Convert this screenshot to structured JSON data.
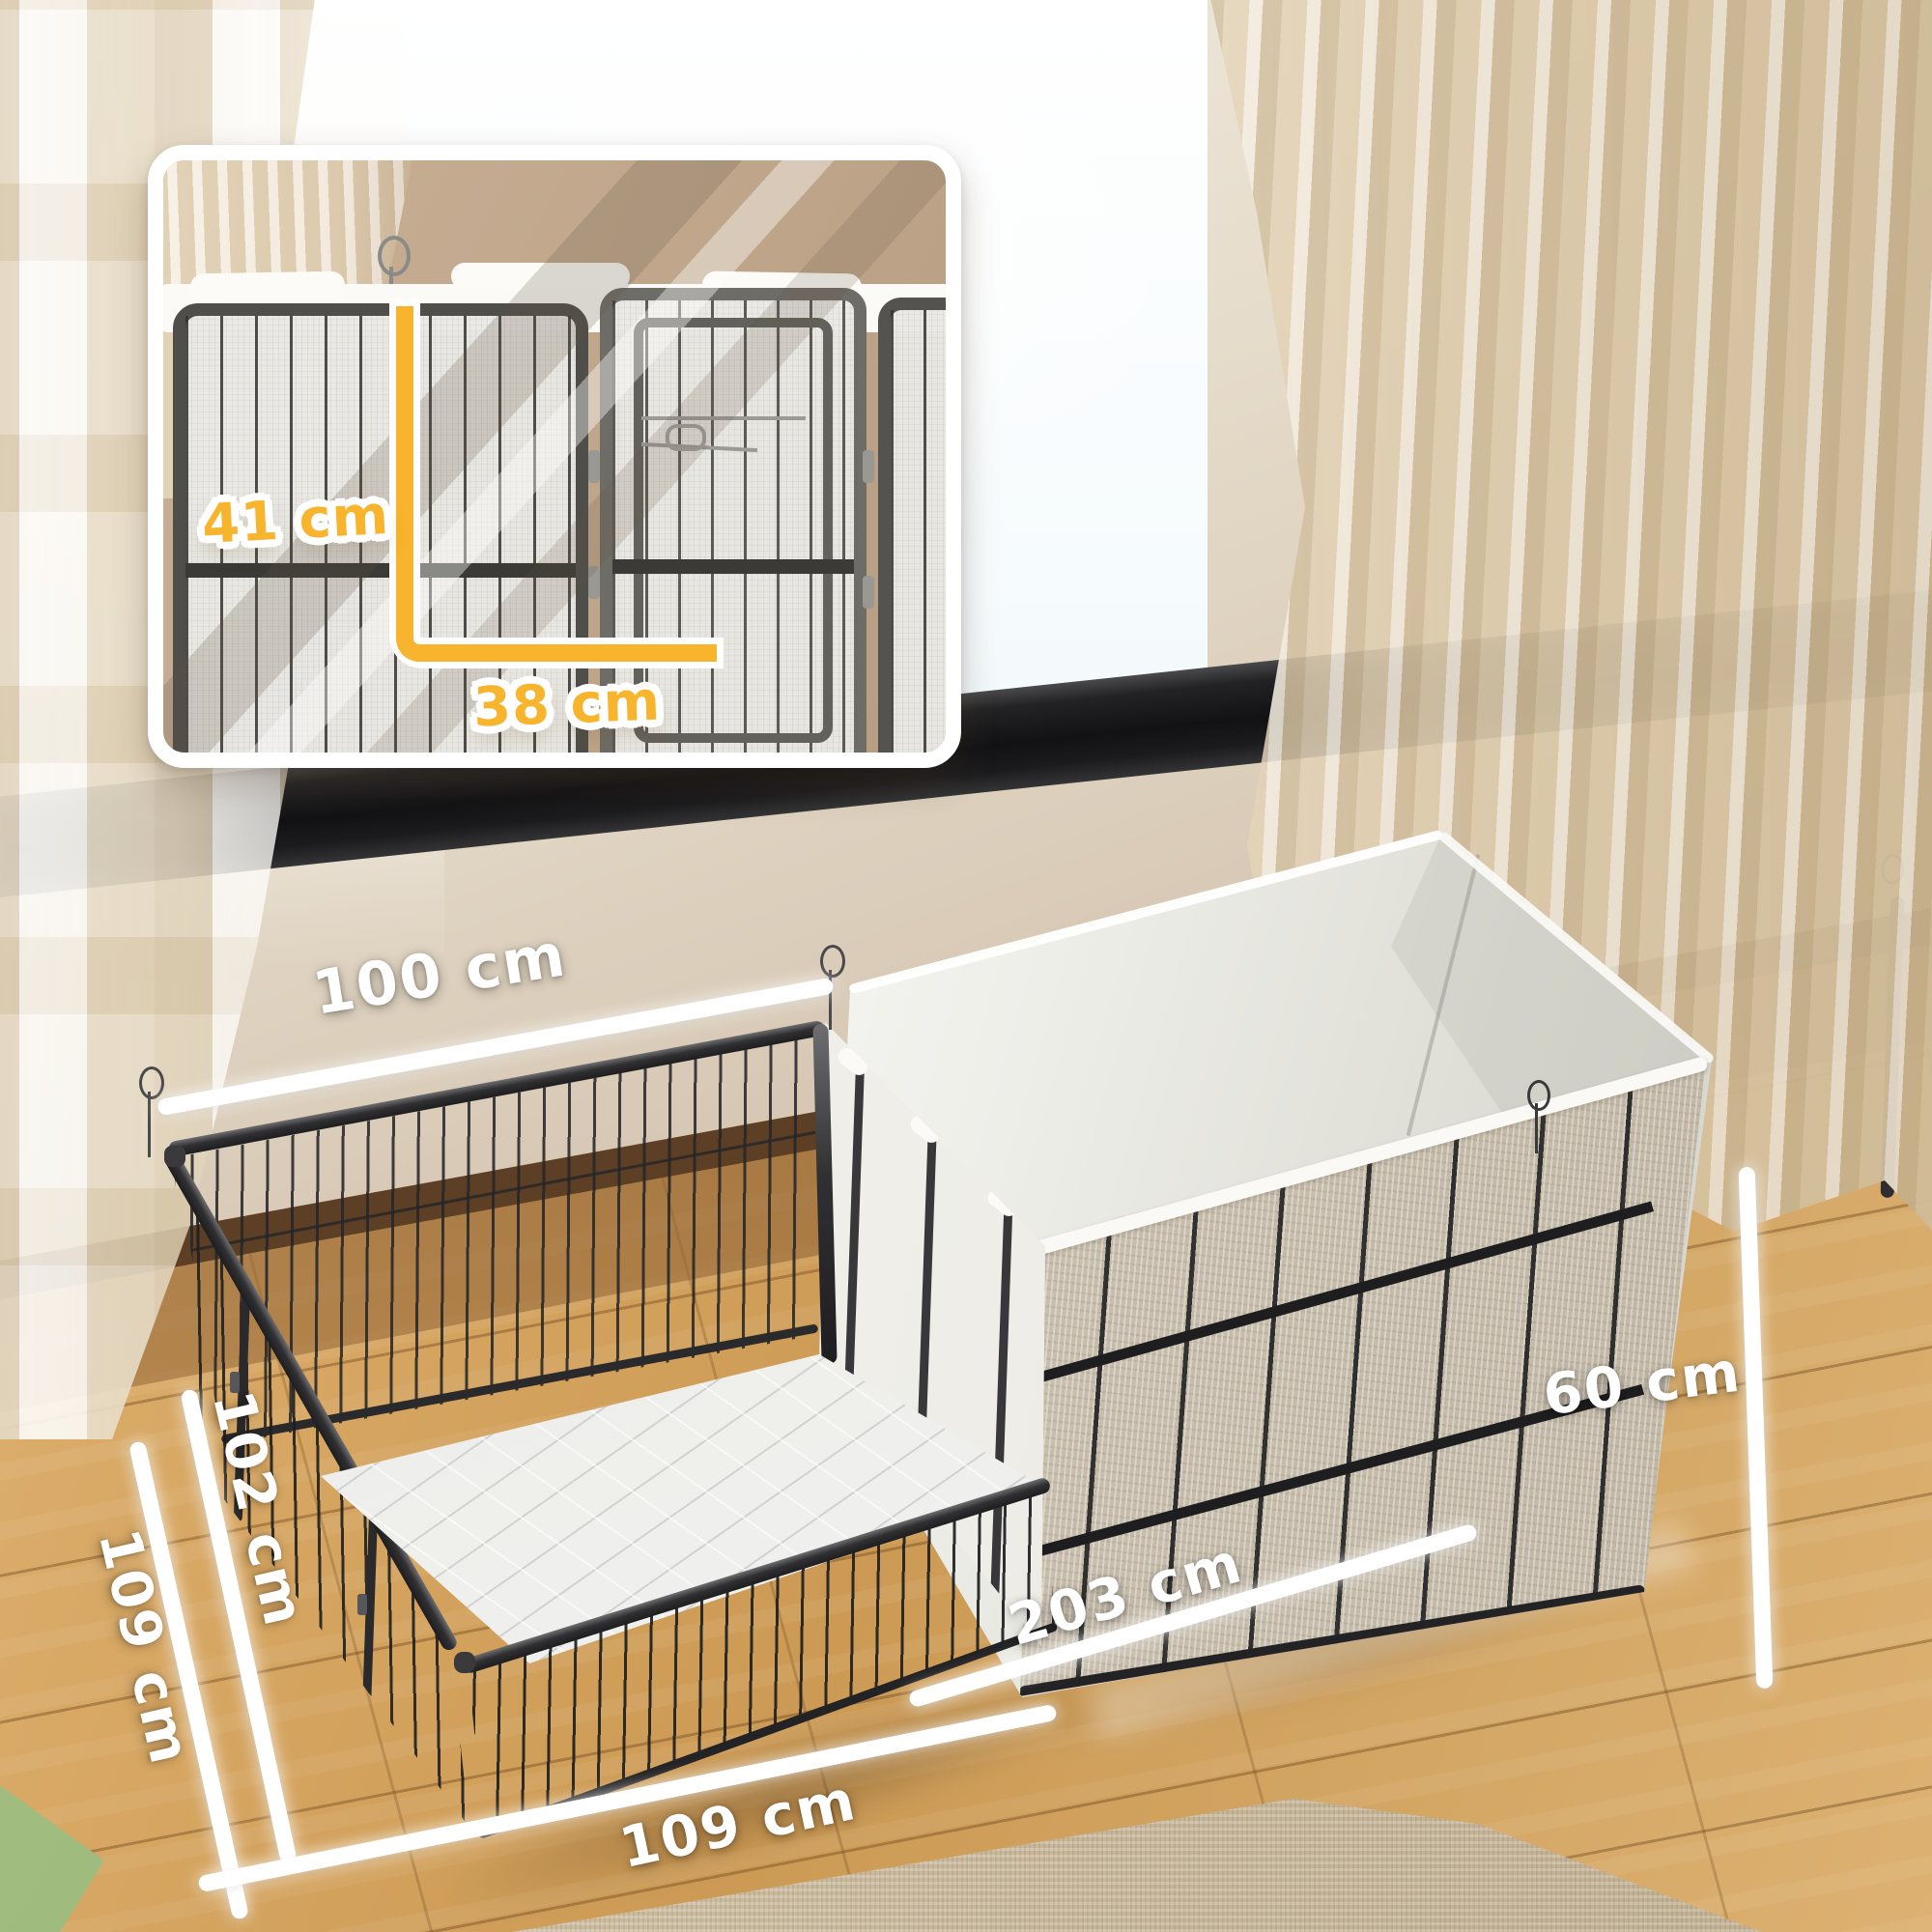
{
  "scene": {
    "description": "Two-section metal pet playpen (open wire pen + fabric-lined whelping pen) in a sunlit room with window, curtains and wooden floor",
    "inset_caption_height": "41 cm",
    "inset_caption_width": "38 cm"
  },
  "dimensions": {
    "back_width": "100 cm",
    "side_inner": "102 cm",
    "side_outer": "109 cm",
    "front_width": "109 cm",
    "total_length": "203 cm",
    "panel_height": "60 cm"
  },
  "palette": {
    "accent_yellow": "#F7B42C",
    "annotation_white": "#FFFFFF",
    "frame_metal": "#2B2B2D",
    "wall_beige": "#D5C6B3",
    "window_blue": "#E4F1F7",
    "floor_wood": "#CC9A54",
    "curtain_beige": "#D8C5A5",
    "fabric_liner": "#F7F6F2",
    "front_fabric": "#CCC2B1"
  }
}
